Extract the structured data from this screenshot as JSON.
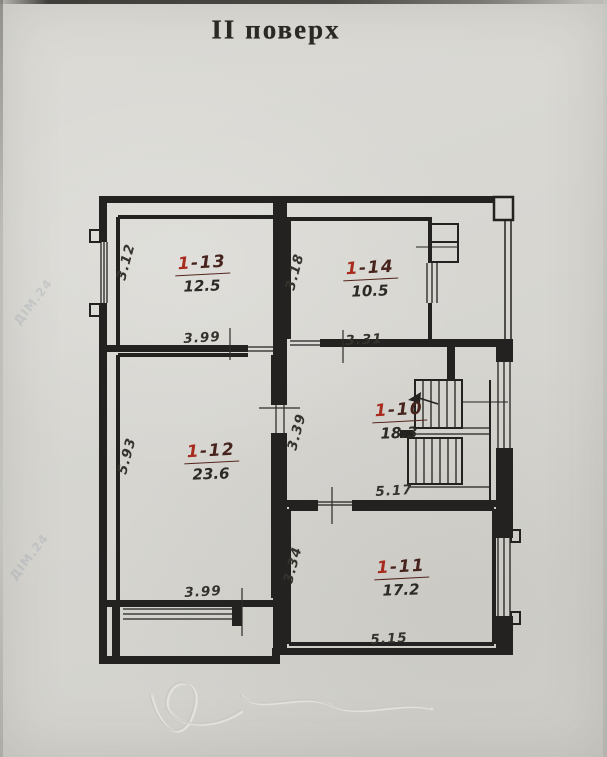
{
  "title": "II поверх",
  "watermark": "ДІМ.24",
  "colors": {
    "ink": "#232220",
    "room_number_red": "#a82c1e",
    "room_number_dark": "#46231c",
    "paper": "#d7d6d1"
  },
  "rooms": [
    {
      "prefix": "1",
      "suffix": "-13",
      "area": "12.5"
    },
    {
      "prefix": "1",
      "suffix": "-14",
      "area": "10.5"
    },
    {
      "prefix": "1",
      "suffix": "-12",
      "area": "23.6"
    },
    {
      "prefix": "1",
      "suffix": "-10",
      "area": "18.3"
    },
    {
      "prefix": "1",
      "suffix": "-11",
      "area": "17.2"
    }
  ],
  "dimensions": [
    {
      "value": "3.12",
      "edge": "left-of-room-1-13"
    },
    {
      "value": "3.99",
      "edge": "bottom-of-room-1-13"
    },
    {
      "value": "3.18",
      "edge": "left-of-room-1-14"
    },
    {
      "value": "3.31",
      "edge": "bottom-of-room-1-14"
    },
    {
      "value": "5.93",
      "edge": "left-of-room-1-12"
    },
    {
      "value": "3.99",
      "edge": "bottom-of-room-1-12"
    },
    {
      "value": "3.39",
      "edge": "door-wall-of-room-1-10"
    },
    {
      "value": "5.17",
      "edge": "bottom-of-room-1-10"
    },
    {
      "value": "3.34",
      "edge": "left-of-room-1-11"
    },
    {
      "value": "5.15",
      "edge": "bottom-of-room-1-11"
    }
  ]
}
